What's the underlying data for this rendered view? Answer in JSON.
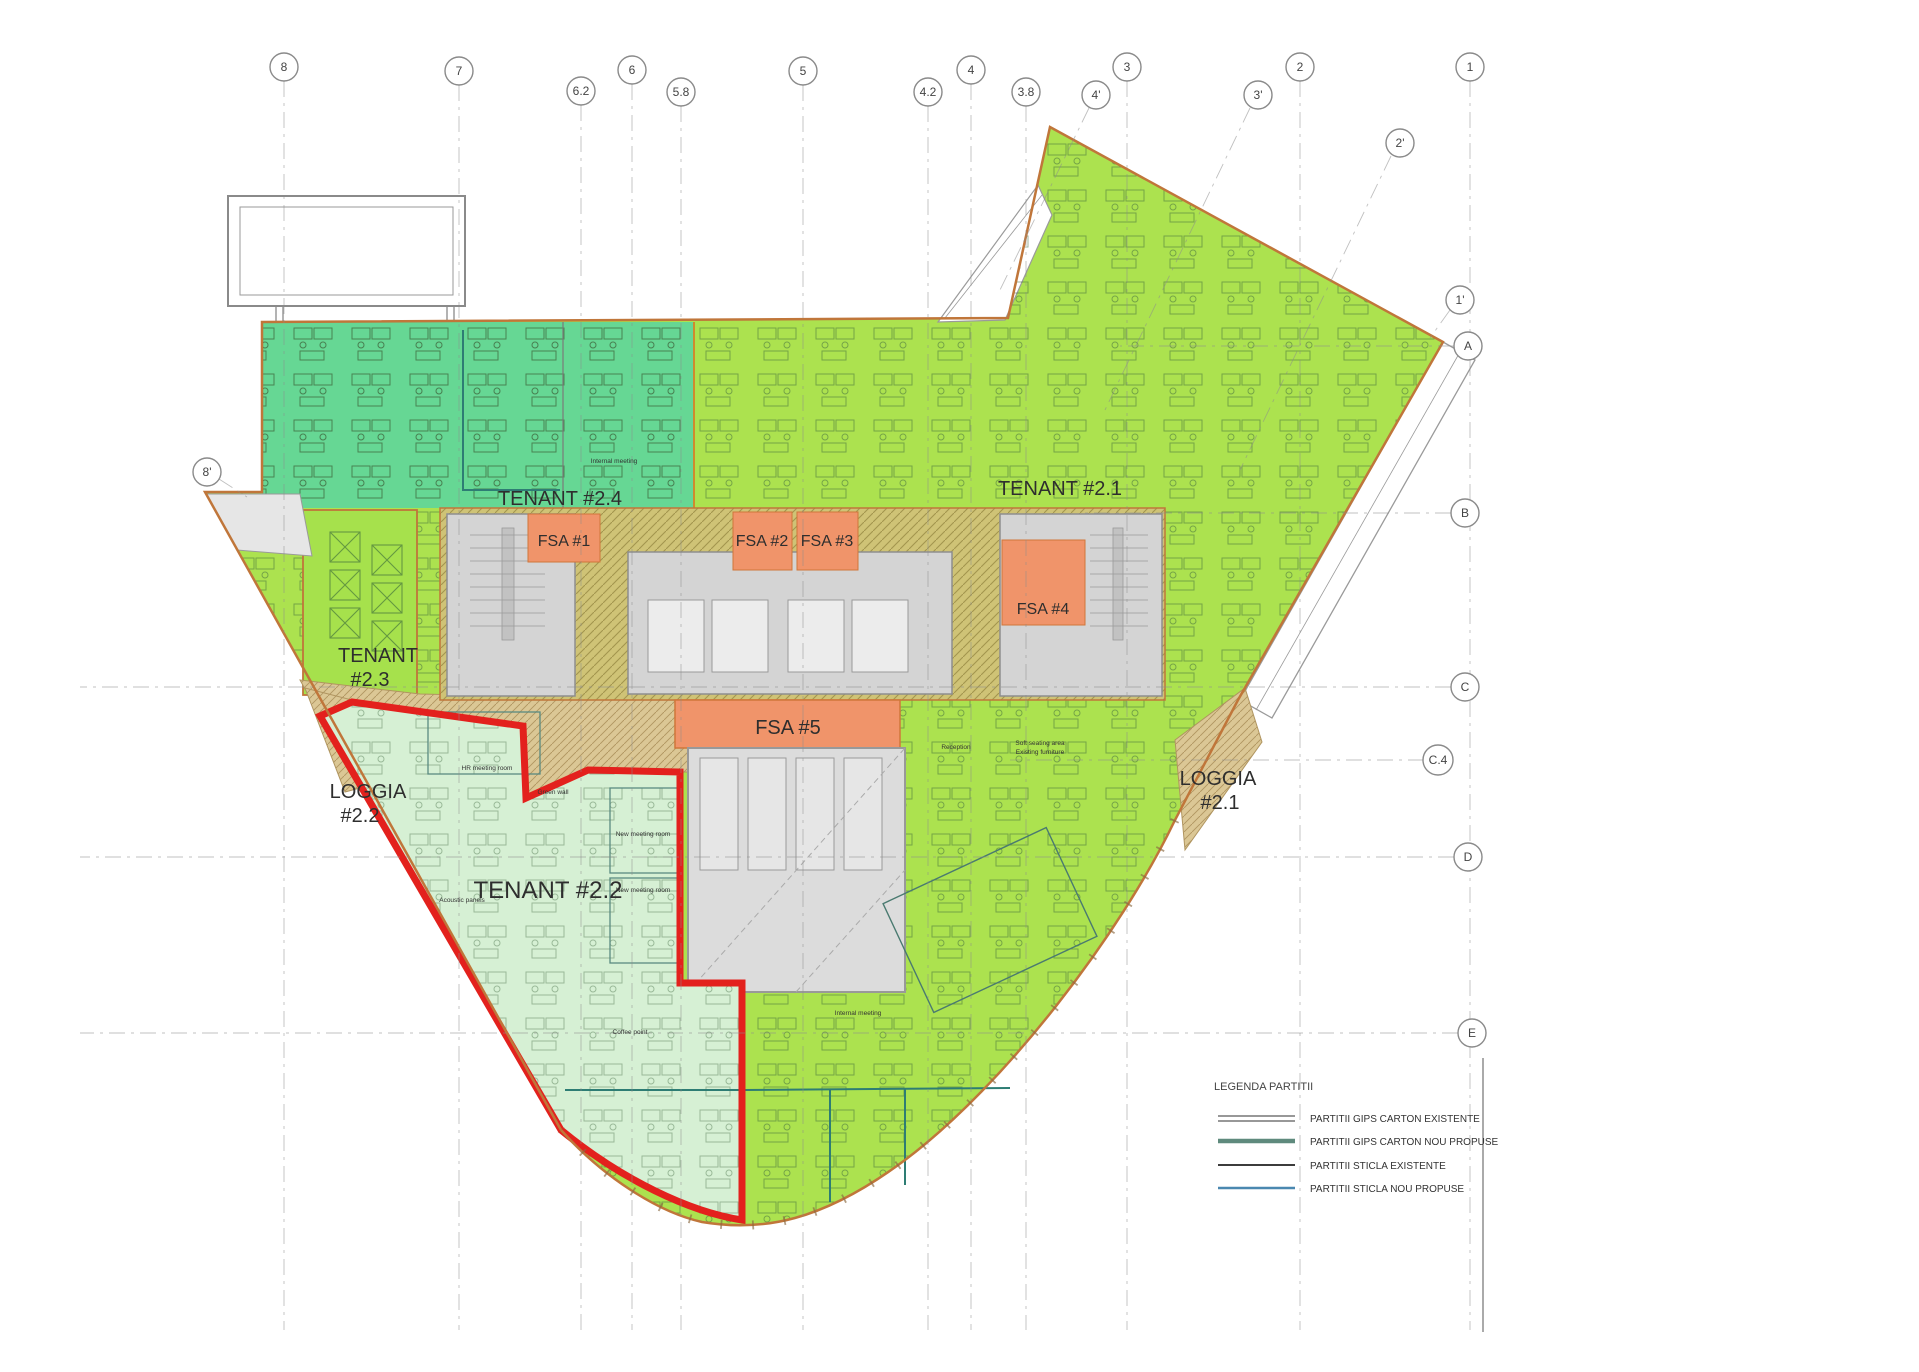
{
  "drawing": {
    "type": "architectural floor plan"
  },
  "grid": {
    "top": [
      {
        "label": "8"
      },
      {
        "label": "7"
      },
      {
        "label": "6.2"
      },
      {
        "label": "6"
      },
      {
        "label": "5.8"
      },
      {
        "label": "5"
      },
      {
        "label": "4.2"
      },
      {
        "label": "4"
      },
      {
        "label": "3.8"
      },
      {
        "label": "3"
      },
      {
        "label": "2"
      },
      {
        "label": "1"
      }
    ],
    "primed": [
      {
        "label": "4'"
      },
      {
        "label": "3'"
      },
      {
        "label": "2'"
      },
      {
        "label": "1'"
      },
      {
        "label": "8'"
      }
    ],
    "right": [
      {
        "label": "A"
      },
      {
        "label": "B"
      },
      {
        "label": "C"
      },
      {
        "label": "C.4"
      },
      {
        "label": "D"
      },
      {
        "label": "E"
      }
    ]
  },
  "rooms": {
    "tenant_2_4": "TENANT #2.4",
    "tenant_2_1": "TENANT #2.1",
    "tenant_2_3_l1": "TENANT",
    "tenant_2_3_l2": "#2.3",
    "tenant_2_2": "TENANT #2.2",
    "fsa_1": "FSA #1",
    "fsa_2": "FSA #2",
    "fsa_3": "FSA #3",
    "fsa_4": "FSA #4",
    "fsa_5": "FSA #5",
    "loggia_2_2_l1": "LOGGIA",
    "loggia_2_2_l2": "#2.2",
    "loggia_2_1_l1": "LOGGIA",
    "loggia_2_1_l2": "#2.1"
  },
  "annotations": {
    "internal_meeting": "Internal meeting",
    "internal_meeting_2": "Internal meeting",
    "reception": "Reception",
    "soft_seating_l1": "Soft seating area",
    "soft_seating_l2": "Existing furniture",
    "hr_meeting": "HR meeting room",
    "green_wall": "Green wall",
    "new_meeting_1": "New meeting room",
    "new_meeting_2": "New meeting room",
    "acoustic_panels": "Acoustic panels",
    "coffee_point": "Coffee point"
  },
  "legend": {
    "title": "LEGENDA PARTITII",
    "items": [
      {
        "label": "PARTITII GIPS CARTON EXISTENTE",
        "symbol": "double-gray-line"
      },
      {
        "label": "PARTITII GIPS CARTON NOU PROPUSE",
        "symbol": "thick-teal-line"
      },
      {
        "label": "PARTITII STICLA EXISTENTE",
        "symbol": "thin-dark-line"
      },
      {
        "label": "PARTITII STICLA NOU PROPUSE",
        "symbol": "blue-line"
      }
    ]
  },
  "colors": {
    "tenant_green": "#ace24f",
    "tenant_teal": "#66d794",
    "tenant_mint": "#d6f0d4",
    "fsa_orange": "#f0946a",
    "core_hatch_bg": "#cfc376",
    "loggia_tan": "#dbc795",
    "core_gray": "#d4d4d4",
    "atrium_gray": "#dcdcdc",
    "boundary_red": "#e3211d",
    "facade_orange": "#c0763a",
    "partition_teal": "#2e7d74",
    "partition_blue": "#4a88b0"
  }
}
